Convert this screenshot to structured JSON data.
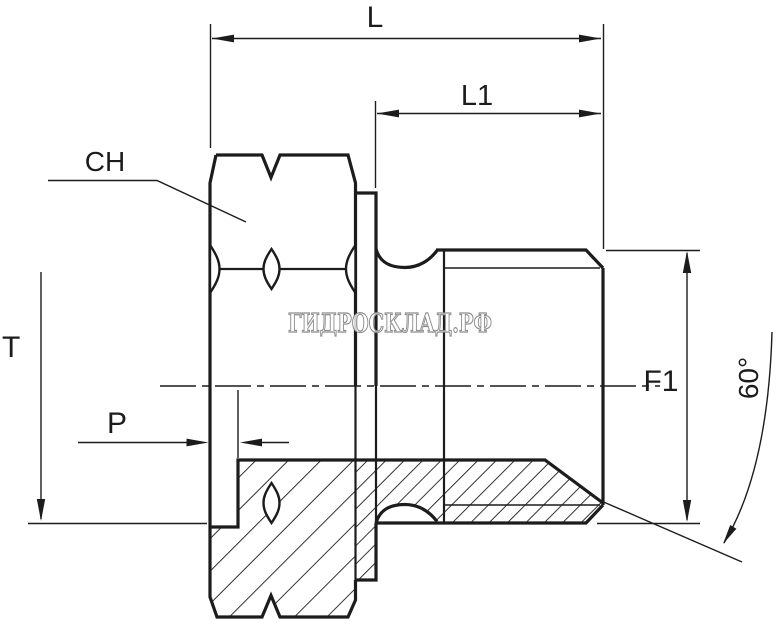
{
  "drawing": {
    "watermark": "ГИДРОСКЛАД.РФ",
    "labels": {
      "overall_length": "L",
      "thread_length": "L1",
      "hex_across_flats": "CH",
      "port_thread": "T",
      "recess_depth": "P",
      "thread_size": "F1",
      "cone_angle": "60°"
    },
    "colors": {
      "line": "#1c1c1c",
      "watermark_stroke": "#8d8d8d",
      "background": "#ffffff"
    }
  }
}
